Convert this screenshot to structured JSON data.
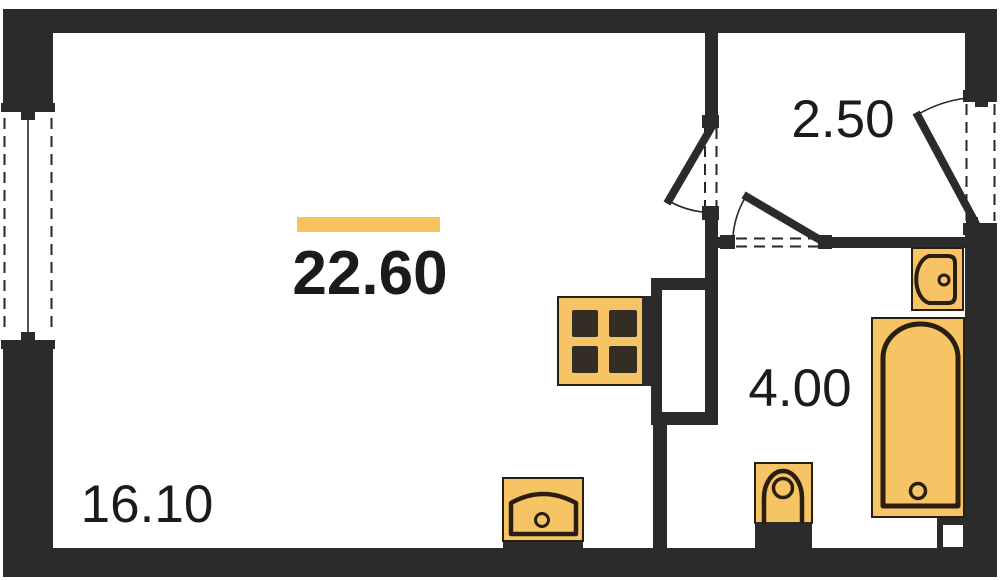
{
  "colors": {
    "background": "#ffffff",
    "wall": "#2b2b2b",
    "fixture_outline": "#2a1e10",
    "fixture_fill": "#f6c464",
    "accent_bar": "#f6c35e",
    "label_text": "#1b1b1b"
  },
  "labels": {
    "total": {
      "area": "22.60"
    },
    "rooms": {
      "living": {
        "area": "16.10"
      },
      "hall": {
        "area": "2.50"
      },
      "bathroom": {
        "area": "4.00"
      }
    }
  },
  "icons": [
    "window-icon",
    "interior-door-icon",
    "bathroom-door-icon",
    "entrance-door-icon",
    "stove-icon",
    "kitchen-sink-icon",
    "ventilation-shaft-icon",
    "toilet-icon",
    "washbasin-icon",
    "bathtub-icon",
    "corner-duct-icon"
  ]
}
